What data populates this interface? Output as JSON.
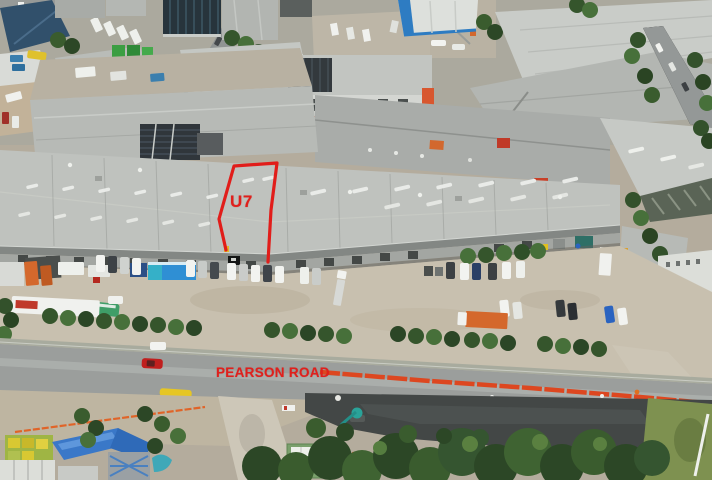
{
  "annotations": {
    "unit_label": "U7",
    "road_label": "PEARSON ROAD",
    "highlight_color": "#e0201c"
  },
  "palette": {
    "main_roof": "#bfc2be",
    "rear_roof": "#b7bab6",
    "right_roof": "#c6c9c5",
    "concrete_yard": "#c8c0af",
    "road_asphalt": "#9b9e9c",
    "fresh_asphalt": "#434746",
    "barrier_orange": "#dd4720",
    "tree_dark": "#33512b",
    "tree_mid": "#47703a",
    "grass": "#7e9150",
    "container_blue": "#2f8fd4",
    "container_orange": "#d4682c"
  }
}
